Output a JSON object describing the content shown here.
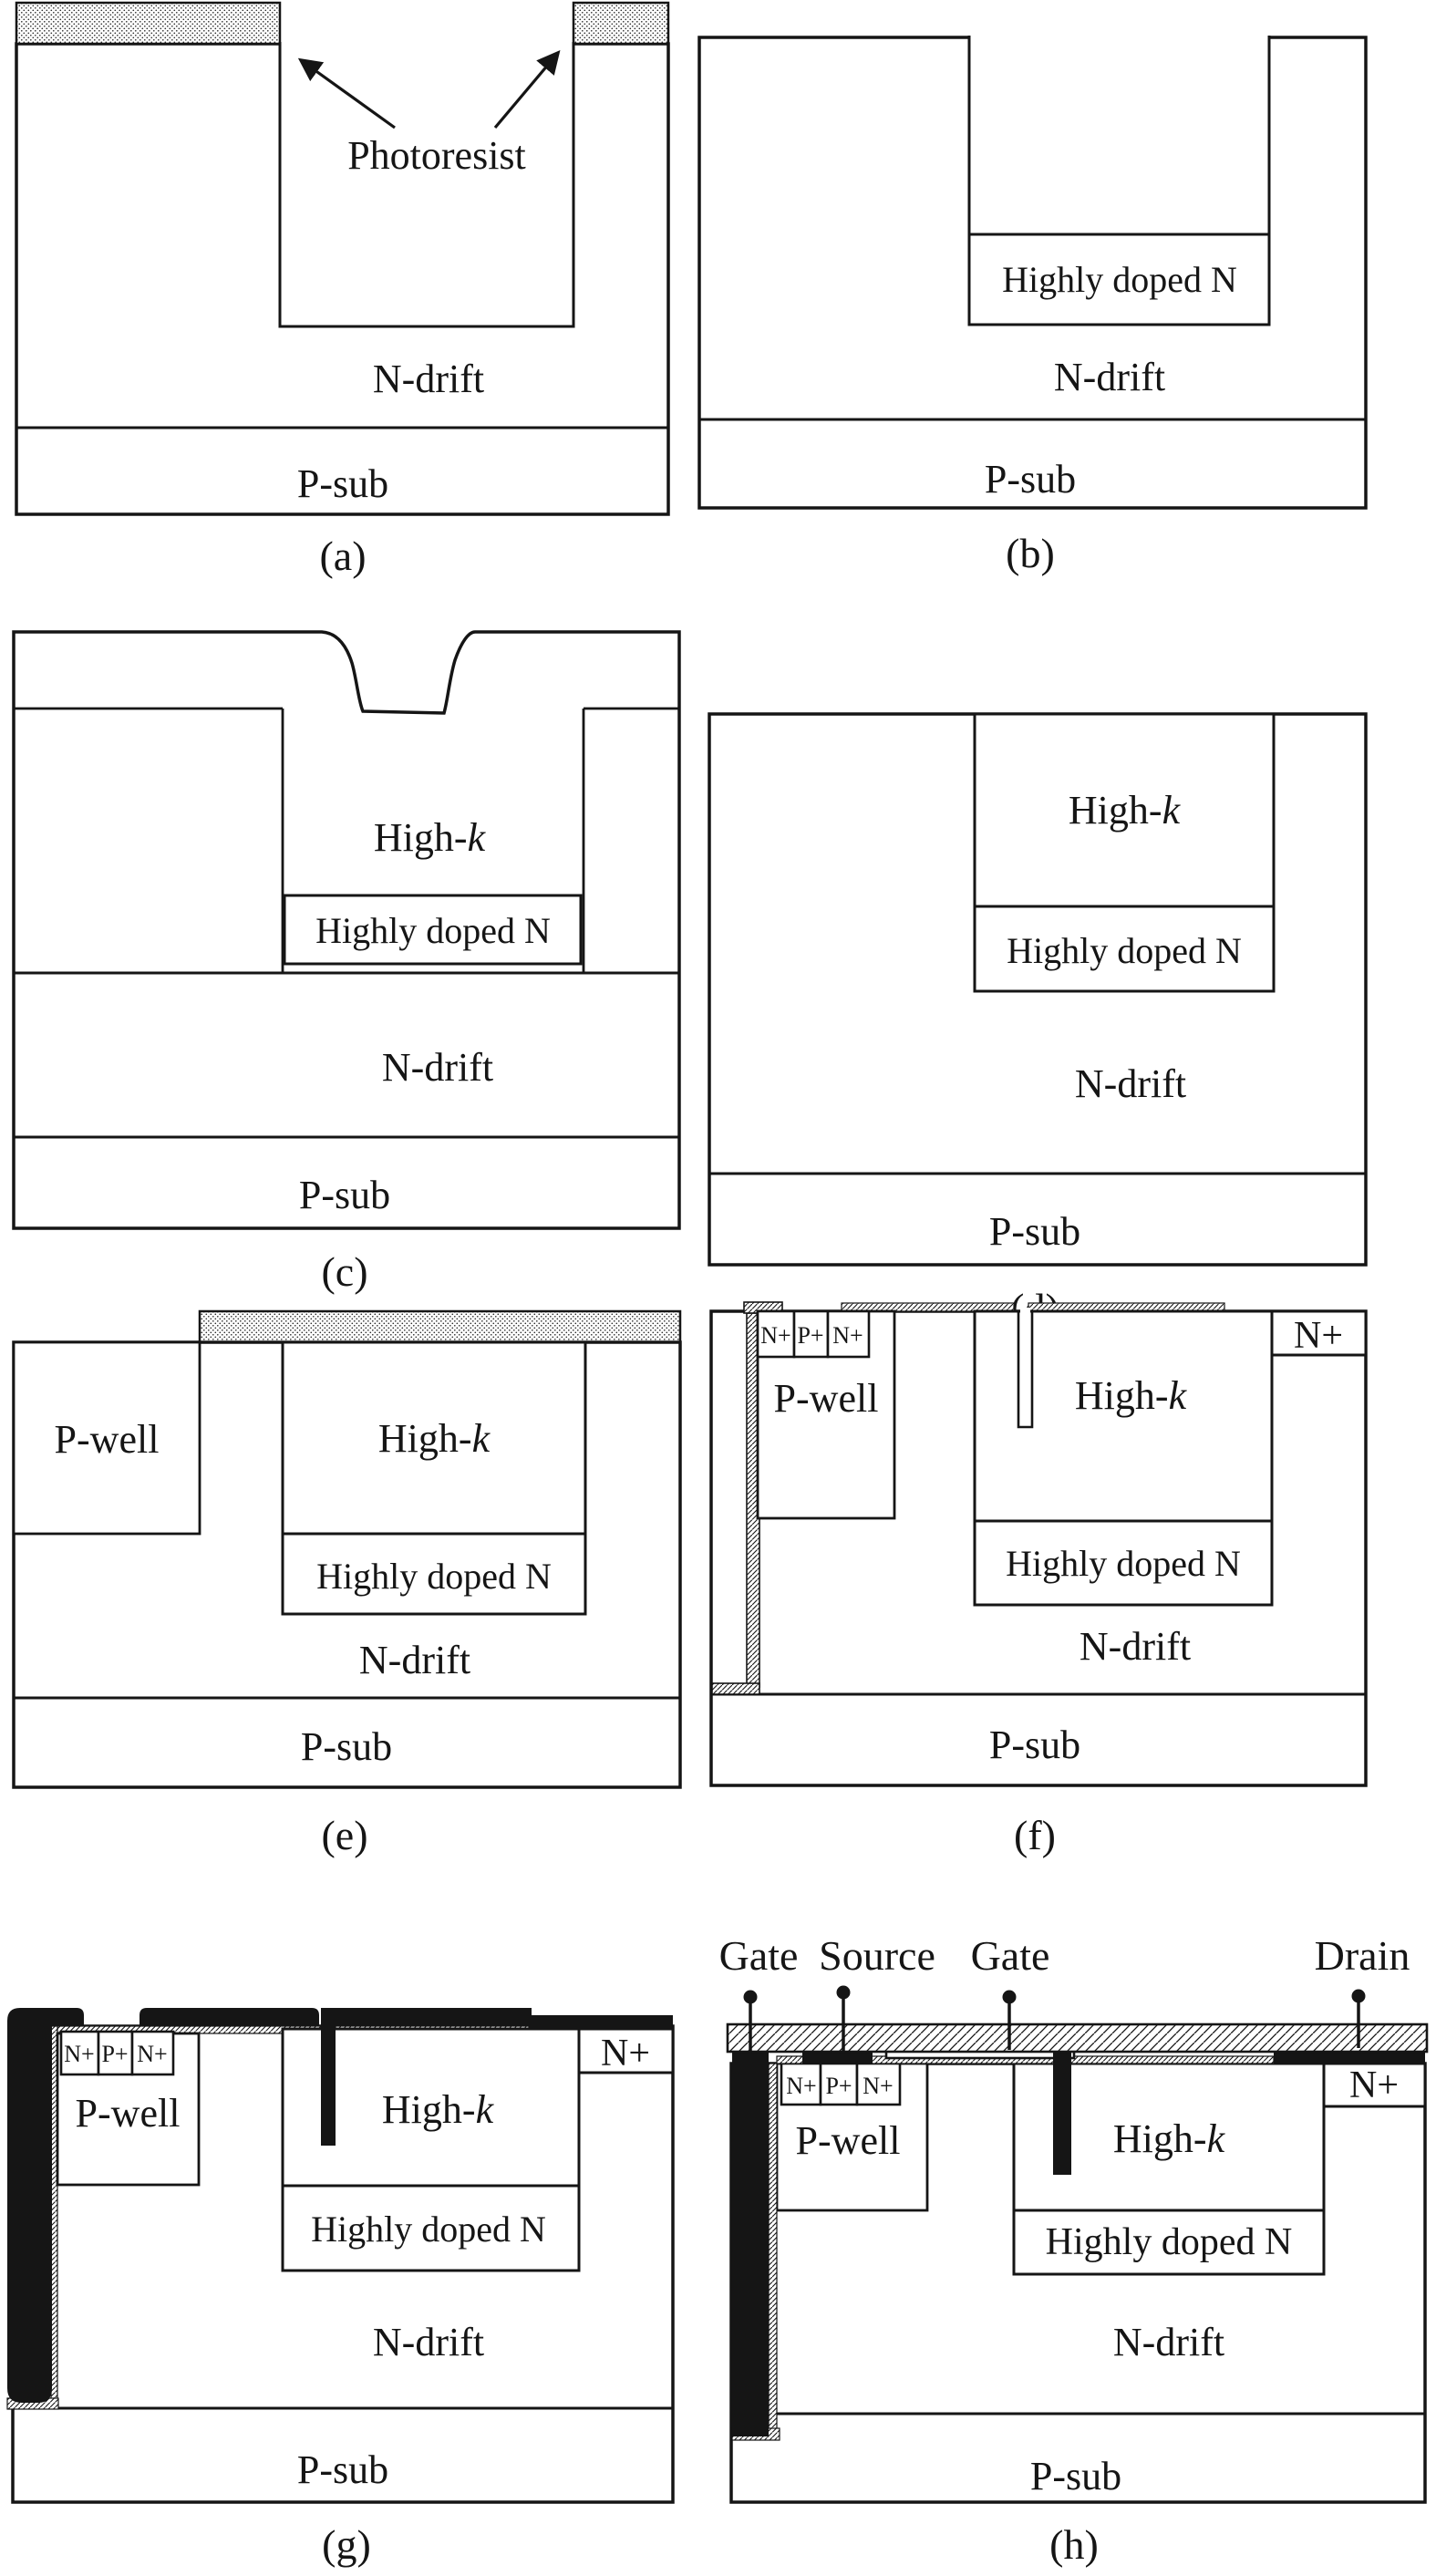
{
  "colors": {
    "background": "#ffffff",
    "line": "#151515",
    "metal": "#151515"
  },
  "panels": {
    "a": {
      "tag": "(a)",
      "photoresist_label": "Photoresist",
      "n_drift": "N-drift",
      "p_sub": "P-sub"
    },
    "b": {
      "tag": "(b)",
      "highly_doped_n": "Highly doped N",
      "n_drift": "N-drift",
      "p_sub": "P-sub"
    },
    "c": {
      "tag": "(c)",
      "high_k_prefix": "High-",
      "high_k_italic": "k",
      "highly_doped_n": "Highly doped N",
      "n_drift": "N-drift",
      "p_sub": "P-sub"
    },
    "d": {
      "tag": "(d)",
      "high_k_prefix": "High-",
      "high_k_italic": "k",
      "highly_doped_n": "Highly doped N",
      "n_drift": "N-drift",
      "p_sub": "P-sub"
    },
    "e": {
      "tag": "(e)",
      "p_well": "P-well",
      "high_k_prefix": "High-",
      "high_k_italic": "k",
      "highly_doped_n": "Highly doped N",
      "n_drift": "N-drift",
      "p_sub": "P-sub"
    },
    "f": {
      "tag": "(f)",
      "n_plus_left": "N+",
      "p_plus": "P+",
      "n_plus_right": "N+",
      "p_well": "P-well",
      "high_k_prefix": "High-",
      "high_k_italic": "k",
      "n_plus_drain": "N+",
      "highly_doped_n": "Highly doped N",
      "n_drift": "N-drift",
      "p_sub": "P-sub"
    },
    "g": {
      "tag": "(g)",
      "n_plus_left": "N+",
      "p_plus": "P+",
      "n_plus_right": "N+",
      "p_well": "P-well",
      "high_k_prefix": "High-",
      "high_k_italic": "k",
      "n_plus_drain": "N+",
      "highly_doped_n": "Highly doped N",
      "n_drift": "N-drift",
      "p_sub": "P-sub"
    },
    "h": {
      "tag": "(h)",
      "gate_left": "Gate",
      "source": "Source",
      "gate_right": "Gate",
      "drain": "Drain",
      "n_plus_left": "N+",
      "p_plus": "P+",
      "n_plus_right": "N+",
      "p_well": "P-well",
      "high_k_prefix": "High-",
      "high_k_italic": "k",
      "n_plus_drain": "N+",
      "highly_doped_n": "Highly doped N",
      "n_drift": "N-drift",
      "p_sub": "P-sub"
    }
  }
}
